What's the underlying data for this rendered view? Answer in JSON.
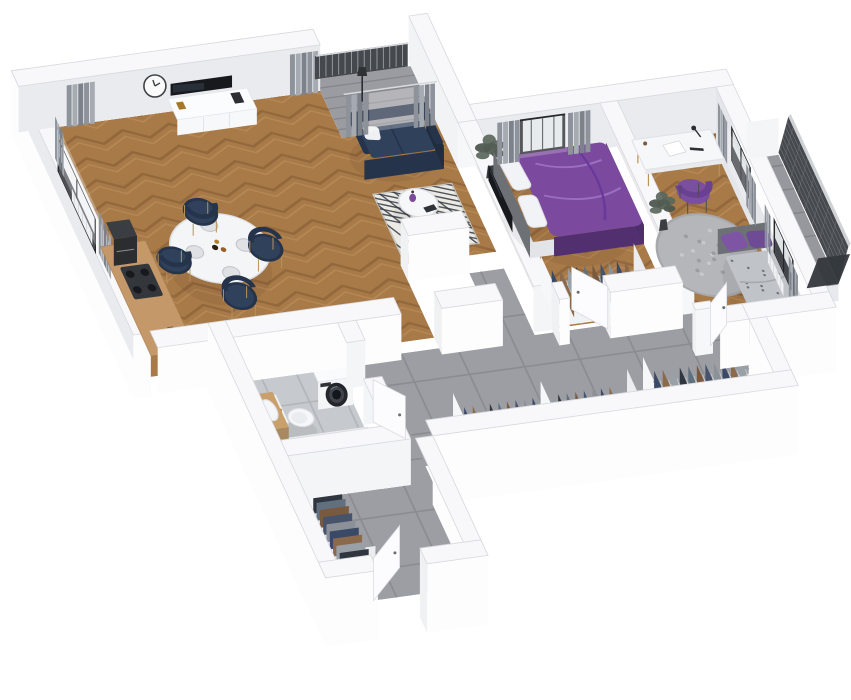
{
  "title": "3D isometric floor plan render of a two-bedroom apartment",
  "colors": {
    "bg": "#ffffff",
    "wallTop": "#f8f8fa",
    "wallBright": "#fdfdfe",
    "wallInner": "#e9ebee",
    "wallInner2": "#e4e6ea",
    "wallStroke": "#d8d9dd",
    "woodBase": "#a87a48",
    "woodDark": "#7f5631",
    "woodLight": "#c69a6a",
    "tileHall": "#9d9ea3",
    "tileHallLine": "#8b8c91",
    "tileBath": "#c6c9cd",
    "tileBathLine": "#b2b5b9",
    "loggiaFloor": "#9b9ca1",
    "navy": "#30415c",
    "navyDark": "#26344b",
    "navySeat": "#3a4d6b",
    "purple": "#7b4a9e",
    "purpleDark": "#52306f",
    "purpleFold": "#9b6fc0",
    "purplePillow": "#7e55a5",
    "chairPurple": "#7a4fa0",
    "whiteFurniture": "#f5f6f8",
    "dark": "#17191d",
    "curtain": "#8e939b",
    "curtainLight": "#b4b9bf",
    "mesh": "#3c4045",
    "meshLine": "#7a7e84",
    "plant": "#5a665c",
    "plantDark": "#49544c",
    "counterWood": "#c49868",
    "blanket": "#c0c4c9",
    "rugRound": "#b4b6ba",
    "rugLiving": "#eceae4",
    "rugLine": "#343a44",
    "doorWhite": "#fcfcfe",
    "clothes": [
      "#3a4a66",
      "#8a6a4a",
      "#9aa0a8",
      "#2f3640",
      "#60707f",
      "#7a5a3f",
      "#46536b",
      "#8c9199"
    ]
  },
  "rooms": [
    {
      "id": "living-room",
      "label": "living room with kitchenette and dining area",
      "floor": "wood-herringbone"
    },
    {
      "id": "loggia",
      "label": "recessed loggia balcony",
      "floor": "concrete"
    },
    {
      "id": "bedroom-1",
      "label": "bedroom with purple double bed",
      "floor": "wood-herringbone"
    },
    {
      "id": "bedroom-2",
      "label": "bedroom with desk and single bed",
      "floor": "wood-herringbone"
    },
    {
      "id": "hallway",
      "label": "hallway with built-in wardrobes",
      "floor": "gray-tile"
    },
    {
      "id": "entry",
      "label": "entry corridor",
      "floor": "gray-tile"
    },
    {
      "id": "bathroom",
      "label": "bathroom",
      "floor": "light-gray-tile"
    },
    {
      "id": "balcony",
      "label": "balcony with mesh railing",
      "floor": "concrete"
    }
  ],
  "furniture": [
    {
      "id": "west-window",
      "room": "living-room",
      "label": "tall black-framed window"
    },
    {
      "id": "west-curtains",
      "room": "living-room",
      "label": "gray curtains"
    },
    {
      "id": "radiator-west",
      "room": "living-room",
      "label": "radiator"
    },
    {
      "id": "wall-clock",
      "room": "living-room",
      "label": "round wall clock"
    },
    {
      "id": "tv-living",
      "room": "living-room",
      "label": "flat TV on wall"
    },
    {
      "id": "media-console",
      "room": "living-room",
      "label": "white media sideboard"
    },
    {
      "id": "north-curtains",
      "room": "living-room",
      "label": "gray curtains"
    },
    {
      "id": "kitchen-counter",
      "room": "living-room",
      "label": "kitchen counter with cooktop"
    },
    {
      "id": "coffee-machine",
      "room": "living-room",
      "label": "black coffee machine"
    },
    {
      "id": "dining-table",
      "room": "living-room",
      "label": "white oval dining table with tableware"
    },
    {
      "id": "dining-chairs",
      "room": "living-room",
      "label": "four navy dining chairs"
    },
    {
      "id": "living-rug",
      "room": "living-room",
      "label": "diamond pattern rug"
    },
    {
      "id": "sofa",
      "room": "living-room",
      "label": "navy sofa"
    },
    {
      "id": "coffee-table",
      "room": "living-room",
      "label": "round coffee table with purple vase"
    },
    {
      "id": "floor-plant-living",
      "room": "bedroom-1",
      "label": "potted plant"
    },
    {
      "id": "loggia-curtains",
      "room": "loggia",
      "label": "curtains at loggia door"
    },
    {
      "id": "loggia-railing",
      "room": "loggia",
      "label": "slatted loggia railing"
    },
    {
      "id": "loggia-floor-lamp",
      "room": "loggia",
      "label": "floor lamp"
    },
    {
      "id": "bed-1",
      "room": "bedroom-1",
      "label": "double bed with purple duvet"
    },
    {
      "id": "wardrobe-bedroom-1",
      "room": "bedroom-1",
      "label": "open wardrobe with clothes"
    },
    {
      "id": "tv-bedroom-1",
      "room": "bedroom-1",
      "label": "wall TV"
    },
    {
      "id": "window-bedroom-1",
      "room": "bedroom-1",
      "label": "window"
    },
    {
      "id": "curtains-bedroom-1",
      "room": "bedroom-1",
      "label": "gray curtains"
    },
    {
      "id": "door-bedroom-1",
      "room": "bedroom-1",
      "label": "white door"
    },
    {
      "id": "desk",
      "room": "bedroom-2",
      "label": "white desk with lamp"
    },
    {
      "id": "desk-chair",
      "room": "bedroom-2",
      "label": "purple chair"
    },
    {
      "id": "rug-bedroom-2",
      "room": "bedroom-2",
      "label": "round gray rug"
    },
    {
      "id": "bed-2",
      "room": "bedroom-2",
      "label": "single bed with gray blanket and purple pillows"
    },
    {
      "id": "plant-bedroom-2",
      "room": "bedroom-2",
      "label": "potted plant"
    },
    {
      "id": "windows-bedroom-2",
      "room": "bedroom-2",
      "label": "two windows"
    },
    {
      "id": "curtains-bedroom-2",
      "room": "bedroom-2",
      "label": "dark gray curtains"
    },
    {
      "id": "radiator-bedroom-2",
      "room": "bedroom-2",
      "label": "radiator"
    },
    {
      "id": "door-bedroom-2",
      "room": "bedroom-2",
      "label": "white door"
    },
    {
      "id": "hall-wardrobe-long",
      "room": "hallway",
      "label": "long open wardrobe with hanging clothes"
    },
    {
      "id": "hall-wardrobe-right",
      "room": "hallway",
      "label": "open wardrobe with hanging clothes"
    },
    {
      "id": "entry-wardrobe",
      "room": "entry",
      "label": "open wardrobe with hanging clothes"
    },
    {
      "id": "entry-door",
      "room": "entry",
      "label": "entrance door, open"
    },
    {
      "id": "washing-machine",
      "room": "bathroom",
      "label": "washing machine"
    },
    {
      "id": "toilet",
      "room": "bathroom",
      "label": "wall-hung toilet with tiled panel"
    },
    {
      "id": "bathtub",
      "room": "bathroom",
      "label": "bathtub"
    },
    {
      "id": "vanity-sink",
      "room": "bathroom",
      "label": "wood vanity with basin"
    },
    {
      "id": "bathroom-door",
      "room": "bathroom",
      "label": "white door"
    },
    {
      "id": "balcony-railing",
      "room": "balcony",
      "label": "dark mesh balcony railing"
    }
  ]
}
